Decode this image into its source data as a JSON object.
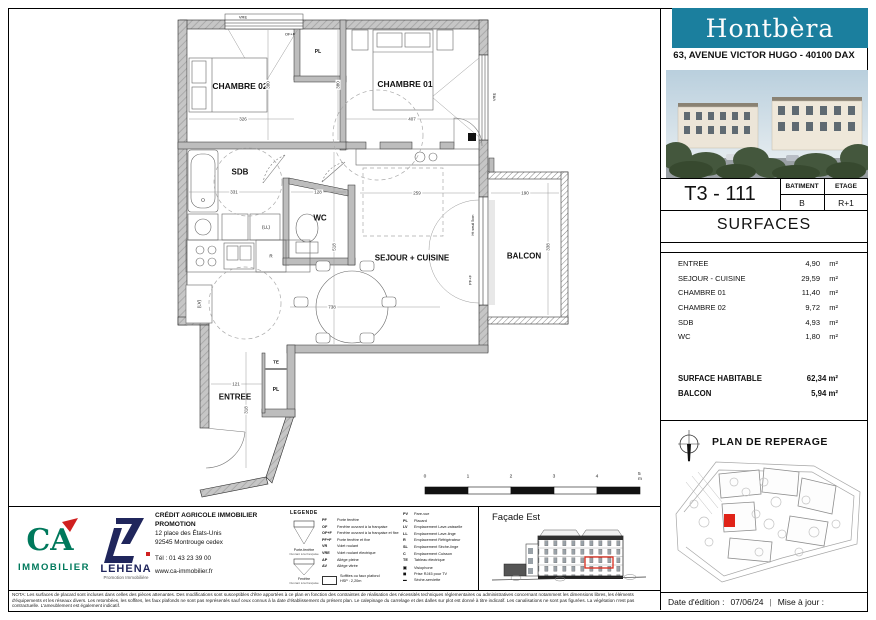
{
  "colors": {
    "banner_teal": "#1b7f9e",
    "highlight_red": "#d92b1c",
    "ca_green": "#00795c",
    "lehena_navy": "#20265c",
    "wall_gray": "#bdbdbd"
  },
  "header": {
    "brand": "Hontbèra",
    "address": "63, AVENUE VICTOR HUGO - 40100 DAX"
  },
  "unit": {
    "code": "T3 - 111",
    "batiment_label": "BATIMENT",
    "batiment_value": "B",
    "etage_label": "ETAGE",
    "etage_value": "R+1"
  },
  "surfaces": {
    "title": "SURFACES",
    "rows": [
      {
        "label": "ENTREE",
        "value": "4,90",
        "unit": "m²"
      },
      {
        "label": "SEJOUR - CUISINE",
        "value": "29,59",
        "unit": "m²"
      },
      {
        "label": "CHAMBRE 01",
        "value": "11,40",
        "unit": "m²"
      },
      {
        "label": "CHAMBRE 02",
        "value": "9,72",
        "unit": "m²"
      },
      {
        "label": "SDB",
        "value": "4,93",
        "unit": "m²"
      },
      {
        "label": "WC",
        "value": "1,80",
        "unit": "m²"
      }
    ],
    "totals": [
      {
        "label": "SURFACE HABITABLE",
        "value": "62,34 m²"
      },
      {
        "label": "BALCON",
        "value": "5,94 m²"
      }
    ]
  },
  "reperage": {
    "title": "PLAN DE REPERAGE"
  },
  "facade": {
    "title": "Façade Est"
  },
  "promoter": {
    "name_line1": "CRÉDIT AGRICOLE IMMOBILIER",
    "name_line2": "PROMOTION",
    "address_line1": "12 place des États-Unis",
    "address_line2": "92545 Montrouge cedex",
    "phone": "Tél : 01 43 23 39 00",
    "website": "www.ca-immobilier.fr",
    "ca_letters": "CA",
    "ca_sub": "IMMOBILIER",
    "lehena_name": "LEHENA",
    "lehena_sub": "Promotion Immobilière"
  },
  "legend": {
    "title": "LEGENDE",
    "window_icons": [
      {
        "caption": "Porte-fenêtre",
        "sub": "Ouvrant à la française"
      },
      {
        "caption": "Fenêtre",
        "sub": "Ouvrant à la française"
      }
    ],
    "col1": [
      {
        "abbr": "PF",
        "label": "Porte fenêtre"
      },
      {
        "abbr": "OF",
        "label": "Fenêtre ouvrant à la française"
      },
      {
        "abbr": "OF+F",
        "label": "Fenêtre ouvrant à la française et fixe"
      },
      {
        "abbr": "PF+F",
        "label": "Porte fenêtre et fixe"
      },
      {
        "abbr": "VR",
        "label": "Volet roulant"
      },
      {
        "abbr": "VRE",
        "label": "Volet roulant électrique"
      },
      {
        "abbr": "AP",
        "label": "Allège pleine"
      },
      {
        "abbr": "AV",
        "label": "Allège vitrée"
      }
    ],
    "box_item": {
      "label": "Soffites ou faux plafond",
      "sub": "HSP : 2,20m"
    },
    "col2": [
      {
        "abbr": "PV",
        "label": "Pare-vue"
      },
      {
        "abbr": "PL",
        "label": "Placard"
      },
      {
        "abbr": "LV",
        "label": "Emplacement Lave-vaisselle"
      },
      {
        "abbr": "LL",
        "label": "Emplacement Lave-linge"
      },
      {
        "abbr": "R",
        "label": "Emplacement Réfrigérateur"
      },
      {
        "abbr": "SL",
        "label": "Emplacement Sèche-linge"
      },
      {
        "abbr": "C",
        "label": "Emplacement Cuisson"
      },
      {
        "abbr": "TE",
        "label": "Tableau électrique"
      },
      {
        "abbr": "▣",
        "label": "Visiophone"
      },
      {
        "abbr": "◼",
        "label": "Prise RJ45 pour TV"
      },
      {
        "abbr": "▬",
        "label": "Sèche-serviette"
      }
    ]
  },
  "nota": "NOTA: Les surfaces de placard sont incluses dans celles des pièces attenantes. Des modifications sont susceptibles d'être apportées à ce plan en fonction des contraintes de réalisation des nécessités techniques réglementaires ou administratives concernant notamment les dimensions libres, les éléments d'équipements et les réseaux divers. Les retombées, les soffites, les faux plafonds ne sont pas représentés sauf ceux connus à la date d'établissement du présent plan. Le calepinage du carrelage et des dalles sur plot est donné à titre indicatif. Les canalisations ne sont pas figurées. La végétation n'est pas contractuelle. L'ameublement est également indicatif.",
  "footer": {
    "date_label": "Date d'édition :",
    "date_value": "07/06/24",
    "sep": "|",
    "maj_label": "Mise à jour :"
  },
  "plan": {
    "room_labels": [
      {
        "text": "CHAMBRE 02",
        "x": 240,
        "y": 86,
        "size": 8.5,
        "bold": true
      },
      {
        "text": "CHAMBRE 01",
        "x": 405,
        "y": 84,
        "size": 8.5,
        "bold": true
      },
      {
        "text": "SDB",
        "x": 240,
        "y": 172,
        "size": 8,
        "bold": true
      },
      {
        "text": "WC",
        "x": 320,
        "y": 218,
        "size": 8,
        "bold": true
      },
      {
        "text": "SEJOUR + CUISINE",
        "x": 412,
        "y": 258,
        "size": 8,
        "bold": true
      },
      {
        "text": "BALCON",
        "x": 524,
        "y": 256,
        "size": 8,
        "bold": true
      },
      {
        "text": "ENTREE",
        "x": 235,
        "y": 397,
        "size": 8,
        "bold": true
      }
    ],
    "small_labels": [
      {
        "text": "PL",
        "x": 318,
        "y": 52,
        "size": 5,
        "bold": true
      },
      {
        "text": "PL",
        "x": 276,
        "y": 390,
        "size": 5,
        "bold": true
      },
      {
        "text": "TE",
        "x": 276,
        "y": 362,
        "size": 4.5,
        "bold": true
      },
      {
        "text": "(LL)",
        "x": 266,
        "y": 227,
        "size": 4.5
      },
      {
        "text": "R",
        "x": 271,
        "y": 256,
        "size": 4.5
      },
      {
        "text": "(LV)",
        "x": 199,
        "y": 304,
        "size": 4.5,
        "rot": -90
      },
      {
        "text": "VRE",
        "x": 243,
        "y": 17,
        "size": 4
      },
      {
        "text": "OF+F",
        "x": 290,
        "y": 34,
        "size": 4
      },
      {
        "text": "VRE",
        "x": 494,
        "y": 97,
        "size": 4,
        "rot": -90
      },
      {
        "text": "PF+F",
        "x": 470,
        "y": 280,
        "size": 4,
        "rot": -90
      },
      {
        "text": "Ht seuil 5cm",
        "x": 473,
        "y": 225,
        "size": 3.8,
        "rot": -90
      }
    ],
    "dim_labels": [
      {
        "text": "326",
        "x": 243,
        "y": 119,
        "size": 4.5
      },
      {
        "text": "407",
        "x": 412,
        "y": 119,
        "size": 4.5
      },
      {
        "text": "380",
        "x": 268,
        "y": 85,
        "size": 4.5,
        "rot": -90
      },
      {
        "text": "380",
        "x": 338,
        "y": 85,
        "size": 4.5,
        "rot": -90
      },
      {
        "text": "331",
        "x": 234,
        "y": 192,
        "size": 4.5
      },
      {
        "text": "128",
        "x": 318,
        "y": 192,
        "size": 4.5
      },
      {
        "text": "259",
        "x": 417,
        "y": 193,
        "size": 4.5
      },
      {
        "text": "190",
        "x": 525,
        "y": 193,
        "size": 4.5
      },
      {
        "text": "338",
        "x": 548,
        "y": 247,
        "size": 4.5,
        "rot": -90
      },
      {
        "text": "518",
        "x": 334,
        "y": 247,
        "size": 4.5,
        "rot": -90
      },
      {
        "text": "738",
        "x": 332,
        "y": 307,
        "size": 4.5
      },
      {
        "text": "121",
        "x": 236,
        "y": 384,
        "size": 4.5
      },
      {
        "text": "318",
        "x": 246,
        "y": 410,
        "size": 4.5,
        "rot": -90
      }
    ],
    "scale_ticks": [
      {
        "text": "0",
        "x": 0,
        "y": 5
      },
      {
        "text": "1",
        "x": 43,
        "y": 5
      },
      {
        "text": "2",
        "x": 86,
        "y": 5
      },
      {
        "text": "3",
        "x": 129,
        "y": 5
      },
      {
        "text": "4",
        "x": 172,
        "y": 5
      },
      {
        "text": "5 m",
        "x": 215,
        "y": 5
      }
    ]
  }
}
